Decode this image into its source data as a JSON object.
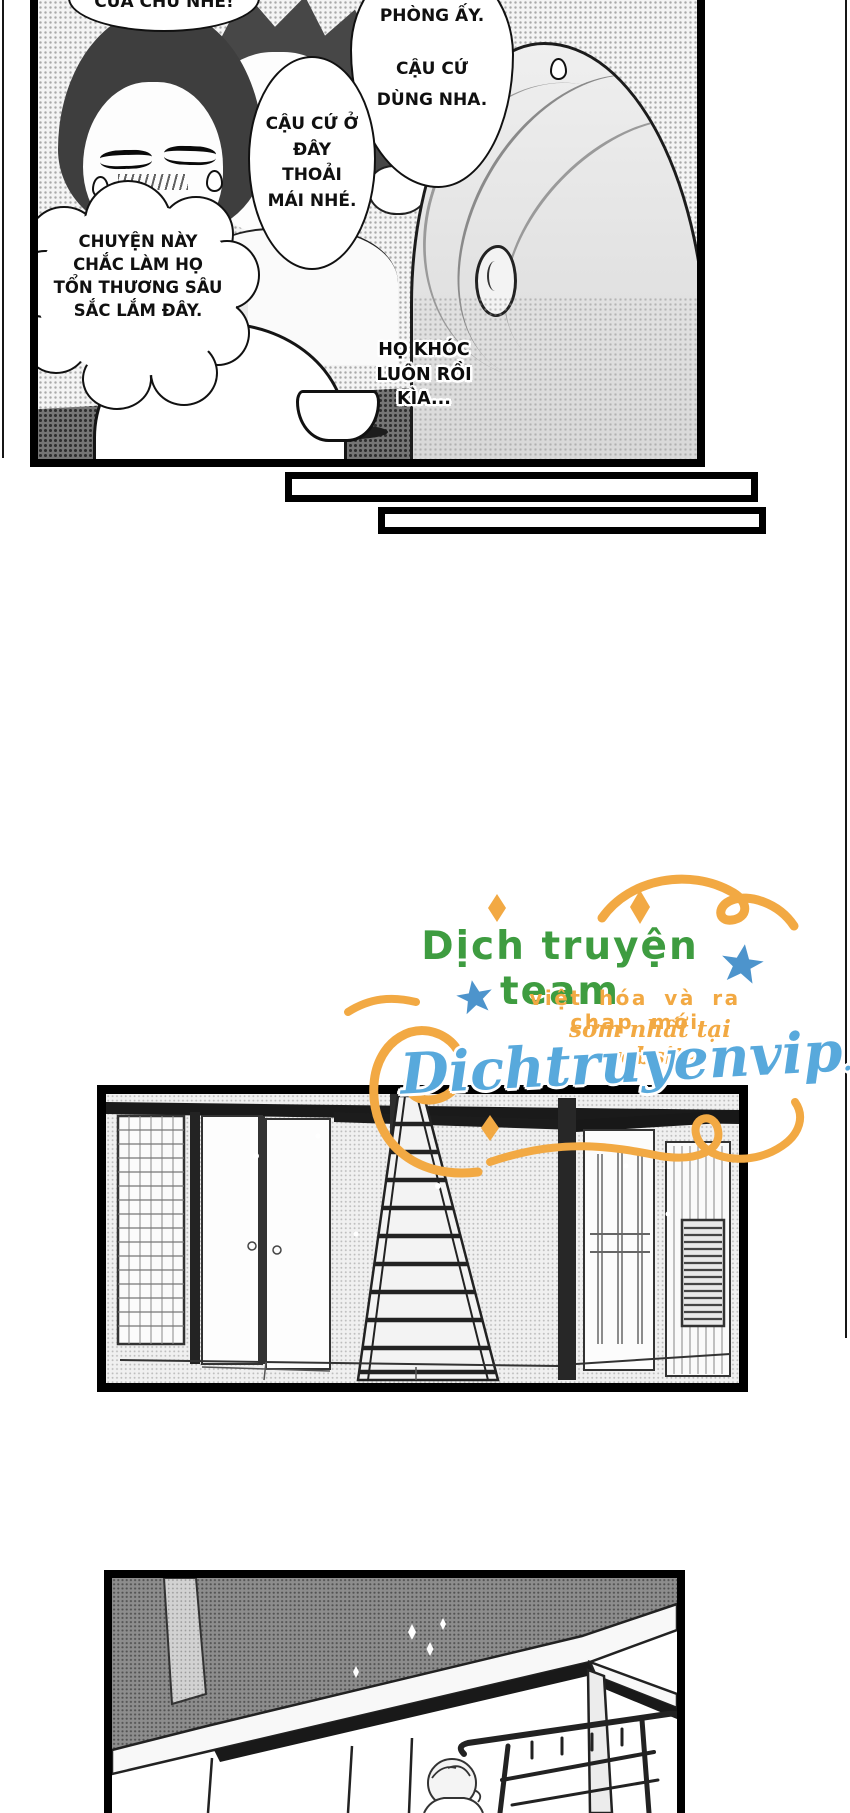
{
  "panel_top": {
    "bubble_cut_top": "CỦA CHÚ NHÉ!",
    "bubble_right_line1": "PHÒNG ẤY.",
    "bubble_right_line2": "CẬU CỨ DÙNG NHA.",
    "bubble_middle": "CẬU CỨ Ở ĐÂY THOẢI MÁI NHÉ.",
    "thought_cloud": "CHUYỆN NÀY CHẮC LÀM HỌ TỔN THƯƠNG SÂU SẮC LẮM ĐÂY.",
    "floating_text": "HỌ KHÓC LUÔN RỒI KÌA..."
  },
  "watermark": {
    "team_name": "Dịch truyện team",
    "tagline1": "việt hóa và ra chap mới",
    "tagline2": "sớm nhất tại website",
    "site_name": "Dichtruyenvip",
    "site_tld": ".com",
    "colors": {
      "orange": "#F2A943",
      "green": "#3E9C40",
      "star_blue": "#4D94CC",
      "script_blue": "#58A9DC"
    }
  }
}
